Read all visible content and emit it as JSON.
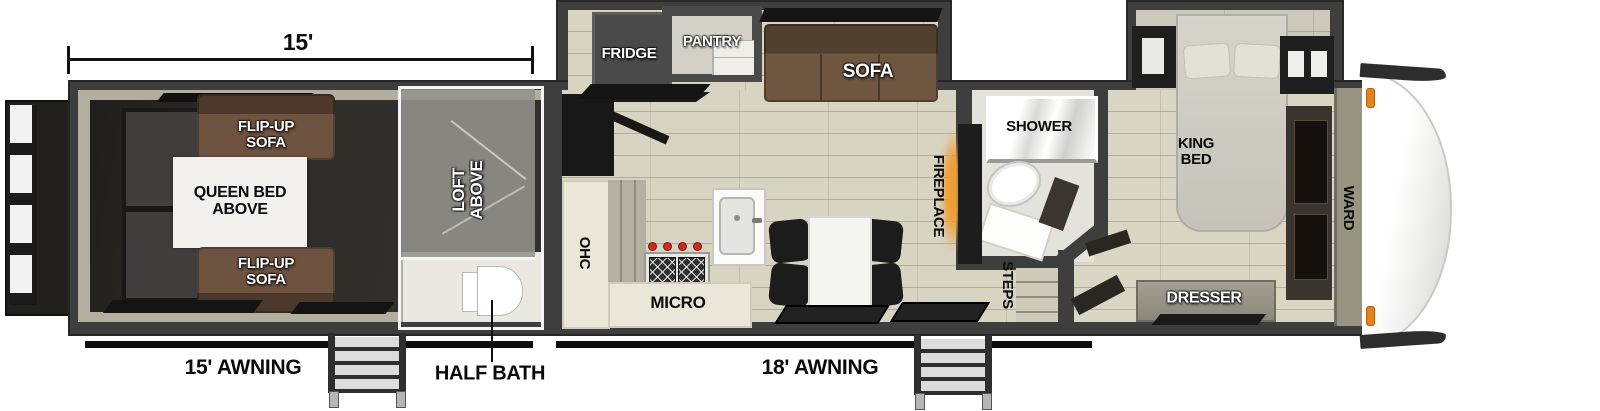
{
  "labels": {
    "dimension": "15'",
    "awning_rear": "15' AWNING",
    "awning_main": "18' AWNING",
    "half_bath": "HALF BATH"
  },
  "garage": {
    "flip_up_sofa_top": "FLIP-UP\nSOFA",
    "queen_bed": "QUEEN BED\nABOVE",
    "flip_up_sofa_bottom": "FLIP-UP\nSOFA",
    "loft": "LOFT\nABOVE"
  },
  "kitchen": {
    "fridge": "FRIDGE",
    "pantry": "PANTRY",
    "sofa": "SOFA",
    "ohc": "OHC",
    "micro": "MICRO",
    "fireplace": "FIREPLACE",
    "steps": "STEPS"
  },
  "bathroom": {
    "shower": "SHOWER"
  },
  "bedroom": {
    "king_bed": "KING\nBED",
    "ward": "WARD",
    "dresser": "DRESSER"
  },
  "colors": {
    "wall": "#3e3e3e",
    "floor": "#d8d4c2",
    "garage_floor": "#2d2b28",
    "sofa_brown": "#6e5340",
    "fireplace_glow": "#f09a28",
    "marker_light": "#e6821c",
    "loft_overlay": "#94928c"
  }
}
